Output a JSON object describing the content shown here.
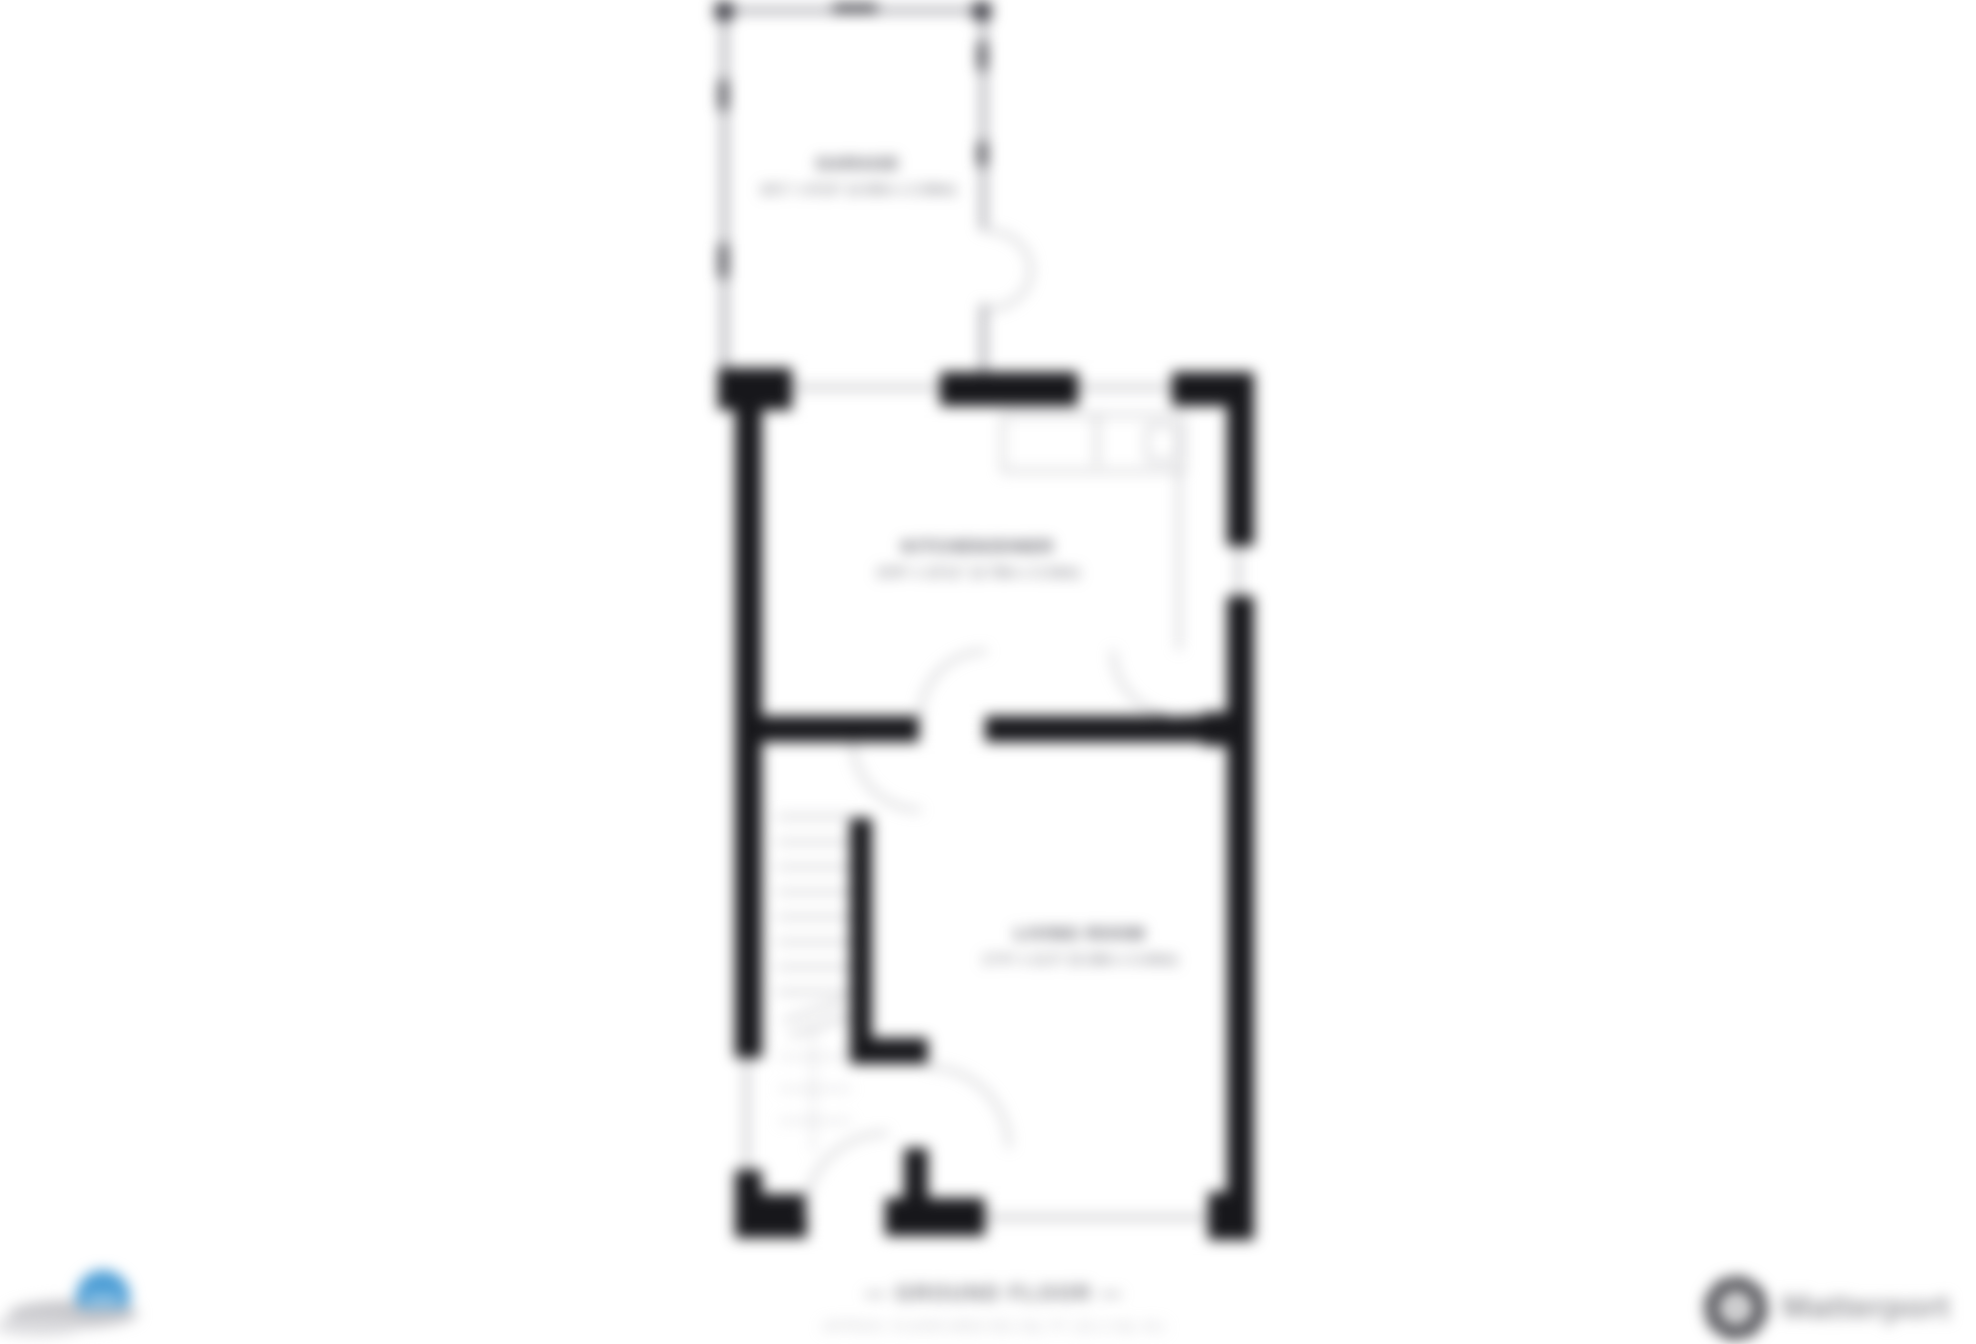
{
  "floorplan": {
    "rooms": [
      {
        "name": "GARAGE",
        "dimensions": "16'1\" x 8'10\" (4.90m x 2.69m)"
      },
      {
        "name": "KITCHEN/DINER",
        "dimensions": "15'8\" x 10'11\" (4.78m x 3.33m)"
      },
      {
        "name": "LIVING ROOM",
        "dimensions": "17'4\" x 11'2\" (5.28m x 3.40m)"
      }
    ],
    "footer": {
      "floor_label": "— GROUND FLOOR —",
      "area_label": "APPROX. FLOOR AREA 551 SQ. FT. (51.2 SQ. M.)"
    }
  },
  "branding": {
    "provider_wordmark": "Matterport"
  },
  "colors": {
    "wall": "#17171b",
    "thin_line": "#9a9aa0",
    "label_text": "#3f3f49",
    "footer_text": "#75757b",
    "area_text": "#c2c2c7",
    "logo_blue": "#4f9fd6",
    "provider_gray": "#98989c"
  }
}
